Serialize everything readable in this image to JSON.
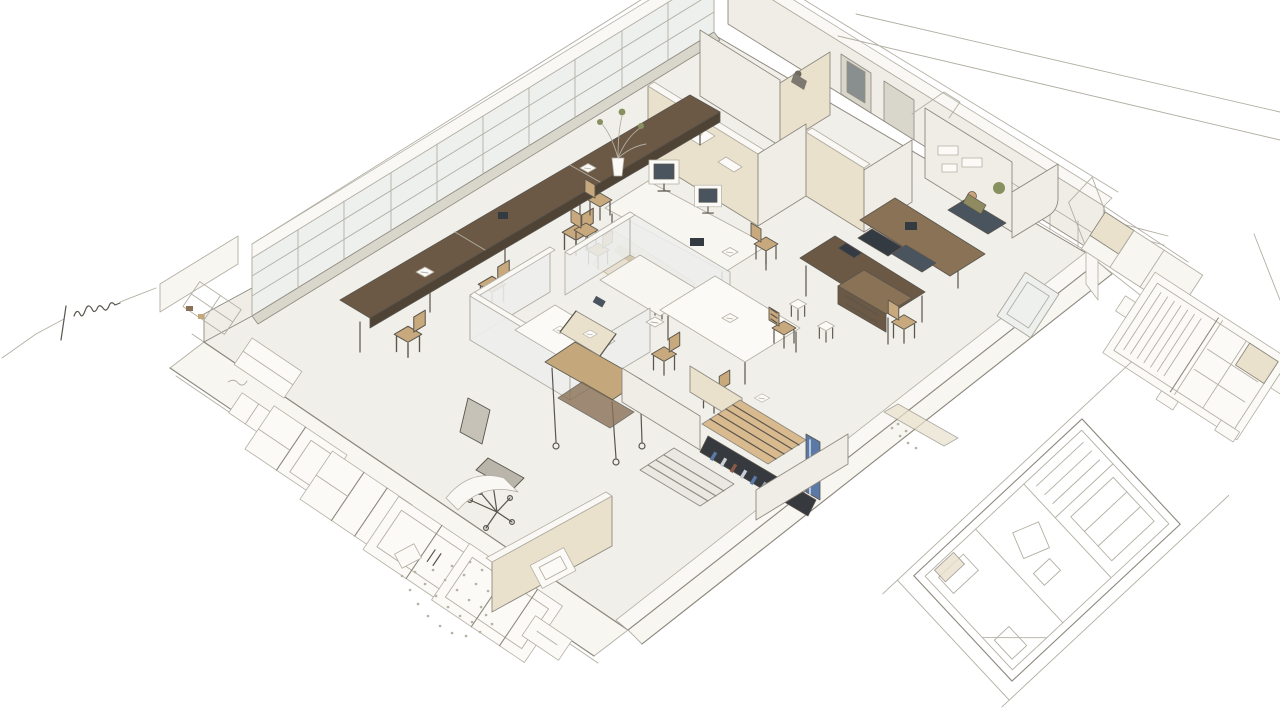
{
  "image": {
    "kind": "hand-drawn architectural illustration",
    "view": "isometric cutaway floor plan of an open office / design studio",
    "width_px": 1280,
    "height_px": 720
  },
  "palette": {
    "bg": "#ffffff",
    "line": "#8e897f",
    "line_light": "#b3afa4",
    "line_dark": "#5a554d",
    "floor": "#f0efe9",
    "floor_bright": "#f7f6f1",
    "wall_beige": "#e9e1cc",
    "wall_beige_dark": "#ddd2b6",
    "wall_white": "#efede6",
    "wall_top": "#f9f8f4",
    "glass": "#eef0ee",
    "mullion": "#a9a59a",
    "sill": "#d9d6cb",
    "wood_dark": "#6b5945",
    "wood_mid": "#8a7257",
    "wood_light": "#c4a87c",
    "stair_wood": "#d9ba8e",
    "tan_seat": "#c8a87d",
    "slate_dark": "#333a42",
    "slate_mid": "#49545e",
    "shelf_dark": "#36393e",
    "accent_blue": "#5b79a6",
    "green": "#87905f",
    "skin": "#c9a27a",
    "olive": "#8f8a5f",
    "paper": "#fbfaf6",
    "gravel": "#b6b2a6",
    "rug": "#e7e0d0",
    "rug_line": "#c7b897"
  },
  "scene": {
    "main_view": {
      "label": "isometric-cutaway-office-floor-plan",
      "elements": [
        "glazed-curtain-wall",
        "clerestory-wall",
        "drafting-workbench-with-stools",
        "central-desk-with-framed-screens",
        "potted-plant",
        "patterned-rug",
        "glass-partition-pods",
        "drafting-cart",
        "office-swivel-chair",
        "meeting-table-with-chairs",
        "kitchen-workstation-island",
        "wood-sideboard",
        "private-office-with-figure",
        "utility-rooms",
        "staircase-with-display-wall",
        "entry-wall-with-plaque",
        "terrace-window-panel-sketches",
        "gravel-texture",
        "corner-room-pencil-sketch"
      ]
    },
    "margin_sketches": [
      "construction-guide-lines",
      "dimension-tick-marks",
      "slatted-panel-detail-sketch",
      "rotated-floor-plan-sketch"
    ],
    "annotations": [
      {
        "name": "handwritten-note",
        "style": "illegible pencil scribble with leader line",
        "position": "left-margin"
      }
    ]
  }
}
